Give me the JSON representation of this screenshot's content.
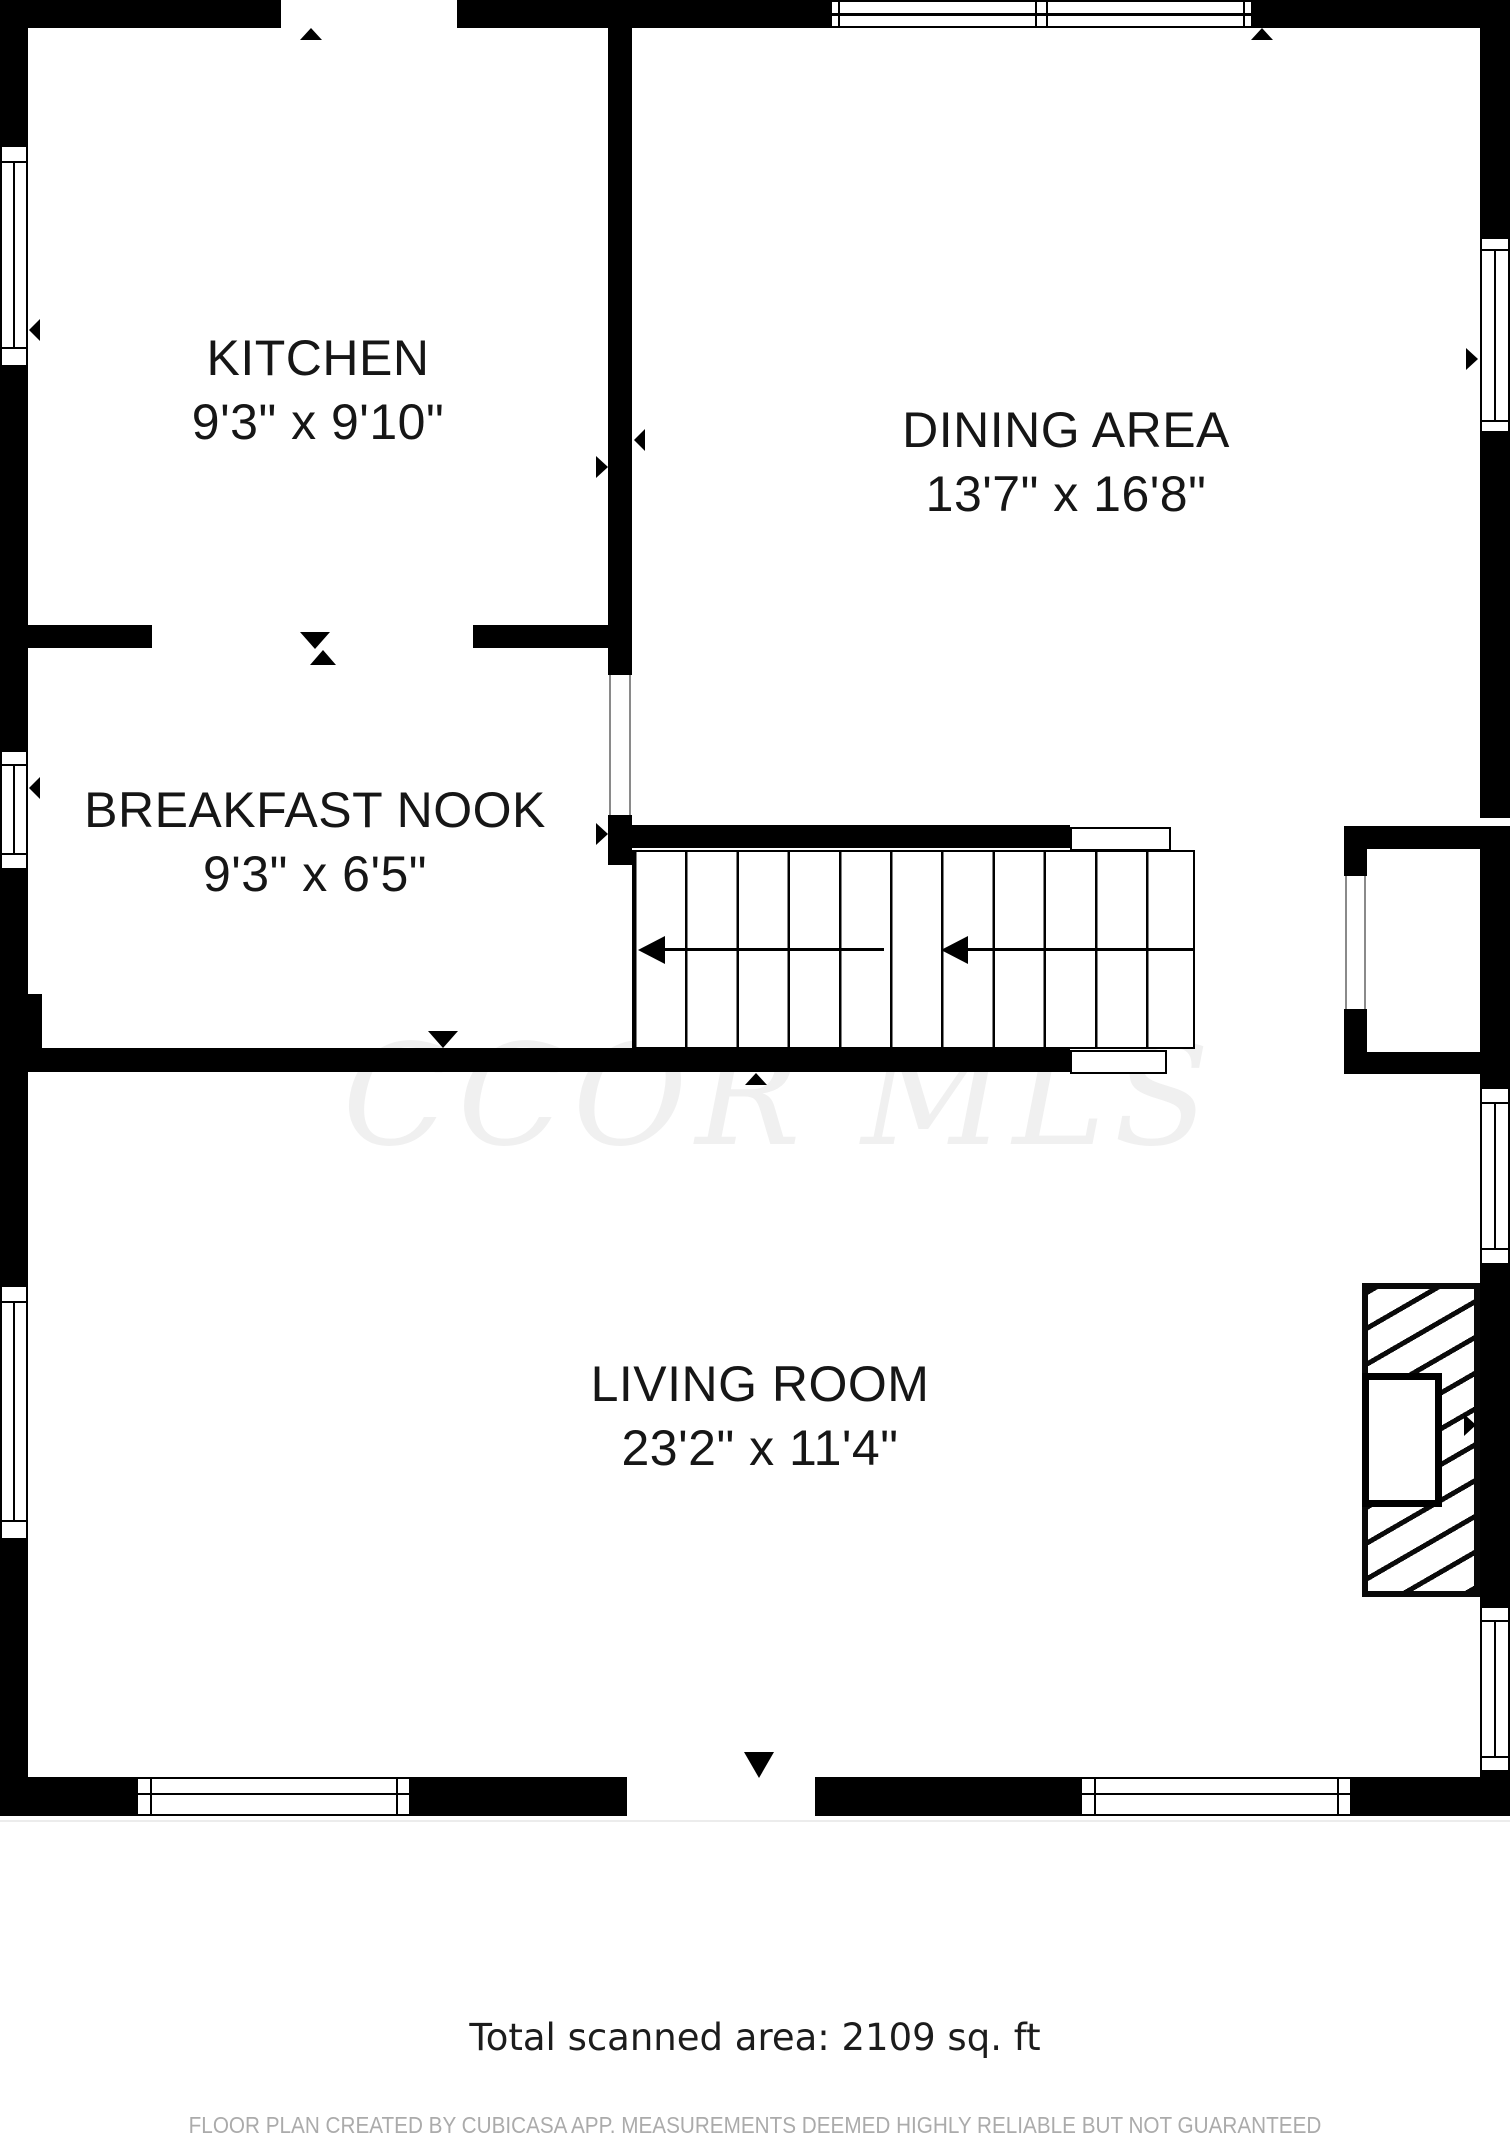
{
  "floor_plan": {
    "rooms": [
      {
        "name": "KITCHEN",
        "dimensions": "9'3\" x 9'10\""
      },
      {
        "name": "DINING AREA",
        "dimensions": "13'7\" x 16'8\""
      },
      {
        "name": "BREAKFAST NOOK",
        "dimensions": "9'3\" x 6'5\""
      },
      {
        "name": "LIVING ROOM",
        "dimensions": "23'2\" x 11'4\""
      }
    ],
    "watermark": "CCOR MLS",
    "footer": {
      "total_area": "Total scanned area: 2109 sq. ft",
      "disclaimer": "FLOOR PLAN CREATED BY CUBICASA APP. MEASUREMENTS DEEMED HIGHLY RELIABLE BUT NOT GUARANTEED"
    },
    "colors": {
      "wall": "#000000",
      "background": "#ffffff",
      "watermark": "#f0f0f0",
      "disclaimer_text": "#ababab"
    }
  }
}
